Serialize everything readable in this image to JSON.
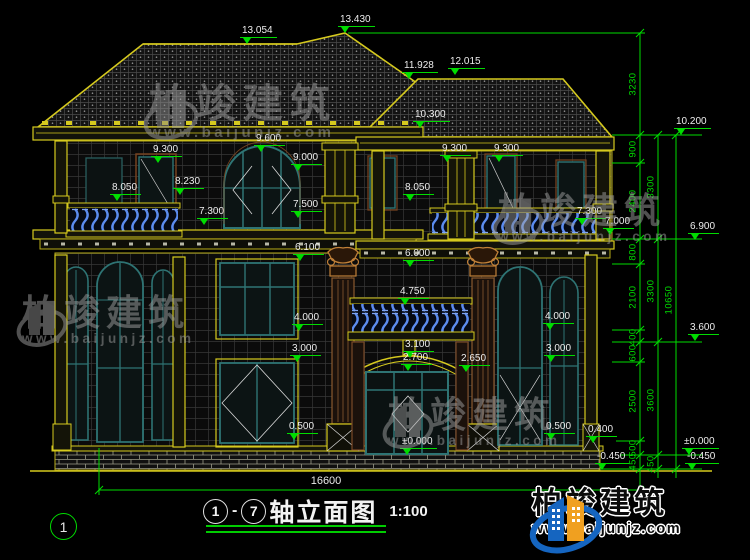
{
  "drawing": {
    "axis_bubble": "1",
    "title_axis_start": "1",
    "title_dash": "-",
    "title_axis_end": "7",
    "title_text": "轴立面图",
    "title_scale": "1:100",
    "total_width": "16600"
  },
  "watermark": {
    "brand": "柏竣建筑",
    "url": "www.baijunjz.com"
  },
  "logo": {
    "brand": "柏竣建筑",
    "url": "www.baijunjz.com"
  },
  "colors": {
    "line_yellow": "#d6ca1e",
    "dim_green": "#00dc00",
    "frame_teal": "#2e7474",
    "baluster_blue": "#5c8cf0",
    "ornament_orange": "#c08038",
    "text_white": "#ededed"
  },
  "levels": [
    {
      "label": "13.054",
      "x": 247,
      "y": 44
    },
    {
      "label": "13.430",
      "x": 345,
      "y": 33
    },
    {
      "label": "11.928",
      "x": 409,
      "y": 79
    },
    {
      "label": "12.015",
      "x": 455,
      "y": 75
    },
    {
      "label": "10.300",
      "x": 420,
      "y": 128
    },
    {
      "label": "10.200",
      "x": 681,
      "y": 135
    },
    {
      "label": "9.300",
      "x": 158,
      "y": 163
    },
    {
      "label": "9.600",
      "x": 261,
      "y": 152
    },
    {
      "label": "9.000",
      "x": 298,
      "y": 171
    },
    {
      "label": "9.300",
      "x": 447,
      "y": 162
    },
    {
      "label": "9.300",
      "x": 499,
      "y": 162
    },
    {
      "label": "8.050",
      "x": 117,
      "y": 201
    },
    {
      "label": "8.230",
      "x": 180,
      "y": 195
    },
    {
      "label": "8.050",
      "x": 410,
      "y": 201
    },
    {
      "label": "7.300",
      "x": 204,
      "y": 225
    },
    {
      "label": "7.500",
      "x": 298,
      "y": 218
    },
    {
      "label": "7.300",
      "x": 582,
      "y": 225
    },
    {
      "label": "7.000",
      "x": 610,
      "y": 235
    },
    {
      "label": "6.900",
      "x": 695,
      "y": 240
    },
    {
      "label": "6.100",
      "x": 300,
      "y": 261
    },
    {
      "label": "6.000",
      "x": 410,
      "y": 267
    },
    {
      "label": "4.750",
      "x": 405,
      "y": 305
    },
    {
      "label": "4.000",
      "x": 299,
      "y": 331
    },
    {
      "label": "4.000",
      "x": 550,
      "y": 330
    },
    {
      "label": "3.600",
      "x": 695,
      "y": 341
    },
    {
      "label": "3.100",
      "x": 410,
      "y": 358
    },
    {
      "label": "3.000",
      "x": 297,
      "y": 362
    },
    {
      "label": "3.000",
      "x": 551,
      "y": 362
    },
    {
      "label": "2.700",
      "x": 408,
      "y": 371
    },
    {
      "label": "2.650",
      "x": 466,
      "y": 372
    },
    {
      "label": "0.500",
      "x": 294,
      "y": 440
    },
    {
      "label": "0.500",
      "x": 551,
      "y": 440
    },
    {
      "label": "0.400",
      "x": 593,
      "y": 443
    },
    {
      "label": "±0.000",
      "x": 407,
      "y": 455
    },
    {
      "label": "±0.000",
      "x": 689,
      "y": 455
    },
    {
      "label": "-0.450",
      "x": 602,
      "y": 470
    },
    {
      "label": "-0.450",
      "x": 692,
      "y": 470
    }
  ],
  "vdims": [
    {
      "label": "3230",
      "x": 633,
      "y": 84
    },
    {
      "label": "900",
      "x": 633,
      "y": 149
    },
    {
      "label": "2400",
      "x": 633,
      "y": 201
    },
    {
      "label": "800",
      "x": 633,
      "y": 252
    },
    {
      "label": "2100",
      "x": 633,
      "y": 297
    },
    {
      "label": "400",
      "x": 633,
      "y": 337
    },
    {
      "label": "600",
      "x": 633,
      "y": 353
    },
    {
      "label": "2500",
      "x": 633,
      "y": 401
    },
    {
      "label": "500",
      "x": 633,
      "y": 448
    },
    {
      "label": "450",
      "x": 633,
      "y": 462
    },
    {
      "label": "3300",
      "x": 651,
      "y": 187
    },
    {
      "label": "3300",
      "x": 651,
      "y": 291
    },
    {
      "label": "3600",
      "x": 651,
      "y": 400
    },
    {
      "label": "450",
      "x": 651,
      "y": 464
    },
    {
      "label": "10650",
      "x": 669,
      "y": 300
    }
  ]
}
